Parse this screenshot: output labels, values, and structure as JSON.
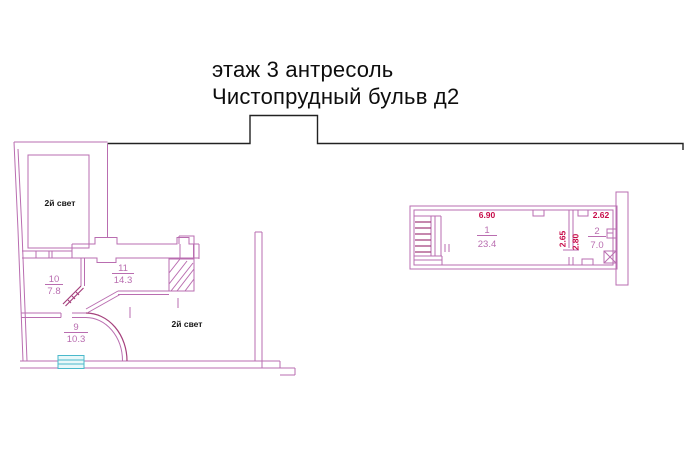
{
  "title": {
    "line1": "этаж 3 антресоль",
    "line2": "Чистопрудный бульв д2"
  },
  "left_plan": {
    "light_label_1": "2й свет",
    "light_label_2": "2й свет",
    "rooms": [
      {
        "number": "10",
        "area": "7.8"
      },
      {
        "number": "11",
        "area": "14.3"
      },
      {
        "number": "9",
        "area": "10.3"
      }
    ]
  },
  "right_plan": {
    "rooms": [
      {
        "number": "1",
        "area": "23.4"
      },
      {
        "number": "2",
        "area": "7.0"
      }
    ],
    "dims": {
      "room1_width": "6.90",
      "room2_width": "2.62",
      "depth_left": "2.65",
      "depth_right": "2.80"
    }
  },
  "colors": {
    "wall": "#b96db0",
    "accent": "#a5417d",
    "dimension": "#c70b49",
    "window": "#4ab9cb",
    "windowFill": "#e8f8f9",
    "outline": "#222222",
    "titleText": "#0d0d0d"
  }
}
